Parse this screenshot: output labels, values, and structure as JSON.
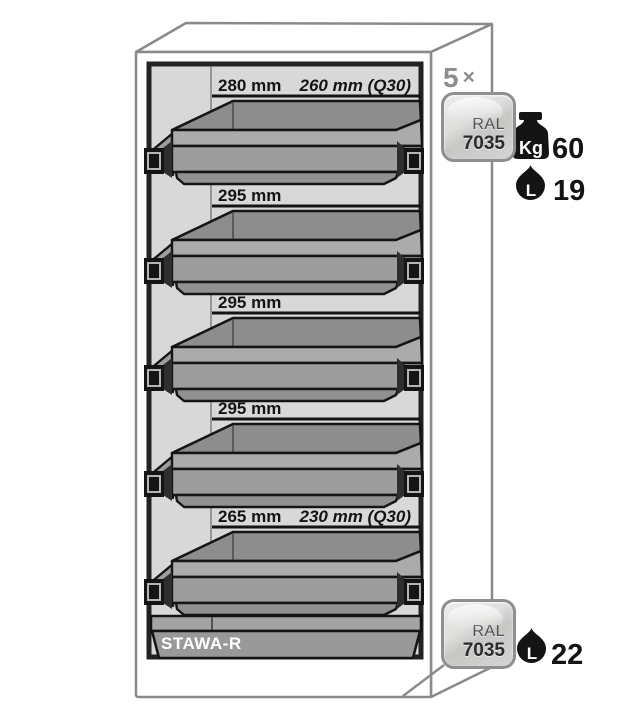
{
  "figure": {
    "type": "safety-cabinet-shelf-diagram",
    "base_label": "STAWA-R",
    "multiplier": {
      "count": "5",
      "symbol": "×"
    },
    "shelves": [
      {
        "inner_depth": "280 mm",
        "q30_depth": "260 mm (Q30)"
      },
      {
        "inner_depth": "295 mm"
      },
      {
        "inner_depth": "295 mm"
      },
      {
        "inner_depth": "295 mm"
      },
      {
        "inner_depth": "265 mm",
        "q30_depth": "230 mm (Q30)"
      }
    ],
    "shelf_spec": {
      "ral_name": "RAL",
      "ral_code": "7035",
      "weight_unit": "Kg",
      "weight_value": "60",
      "volume_unit": "L",
      "volume_value": "19"
    },
    "sump_spec": {
      "ral_name": "RAL",
      "ral_code": "7035",
      "volume_unit": "L",
      "volume_value": "22"
    },
    "colors": {
      "outline_gray": "#8a8a8a",
      "interior_gray": "#d8d8d8",
      "tray_gray": "#9d9d9d",
      "ink": "#141414",
      "badge_gray": "#d5d5d3"
    }
  }
}
